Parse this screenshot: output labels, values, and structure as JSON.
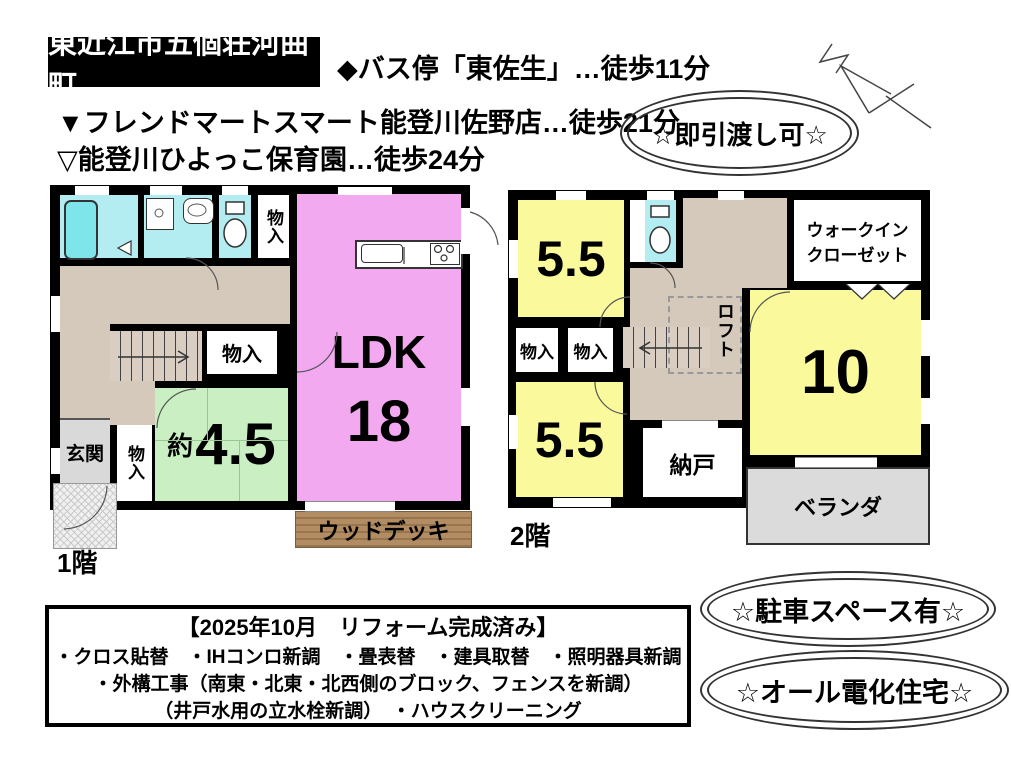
{
  "title_box": "東近江市五個荘河曲町",
  "access": {
    "bus": "◆バス停「東佐生」…徒歩11分",
    "supermarket": "▼フレンドマートスマート能登川佐野店…徒歩21分",
    "nursery": "▽能登川ひよっこ保育園…徒歩24分"
  },
  "badges": {
    "immediate": "☆即引渡し可☆",
    "parking": "☆駐車スペース有☆",
    "all_electric": "☆オール電化住宅☆"
  },
  "floor1": {
    "label": "1階",
    "ldk_label": "LDK",
    "ldk_size": "18",
    "tatami_about": "約",
    "tatami_size": "4.5",
    "entrance": "玄関",
    "storage": "物入",
    "wood_deck": "ウッドデッキ"
  },
  "floor2": {
    "label": "2階",
    "room_a": "5.5",
    "room_b": "5.5",
    "room_c": "10",
    "wic_line1": "ウォークイン",
    "wic_line2": "クローゼット",
    "loft": "ロフト",
    "storage": "物入",
    "nando": "納戸",
    "veranda": "ベランダ"
  },
  "renovation": {
    "title": "【2025年10月　リフォーム完成済み】",
    "items_line1": "・クロス貼替　・IHコンロ新調　・畳表替　・建具取替　・照明器具新調",
    "items_line2": "・外構工事（南東・北東・北西側のブロック、フェンスを新調）",
    "items_line3": "（井戸水用の立水栓新調）　・ハウスクリーニング"
  },
  "colors": {
    "wall_black": "#000000",
    "ldk_pink": "#F2A9F0",
    "room_yellow": "#FAFA9C",
    "tatami_green": "#C9EFC2",
    "wet_cyan": "#B3EDF2",
    "hall_tan": "#D5C9BB",
    "entrance_gray": "#D9D9D9",
    "deck_brown": "#B28D63",
    "veranda_gray": "#DBDBDB"
  }
}
